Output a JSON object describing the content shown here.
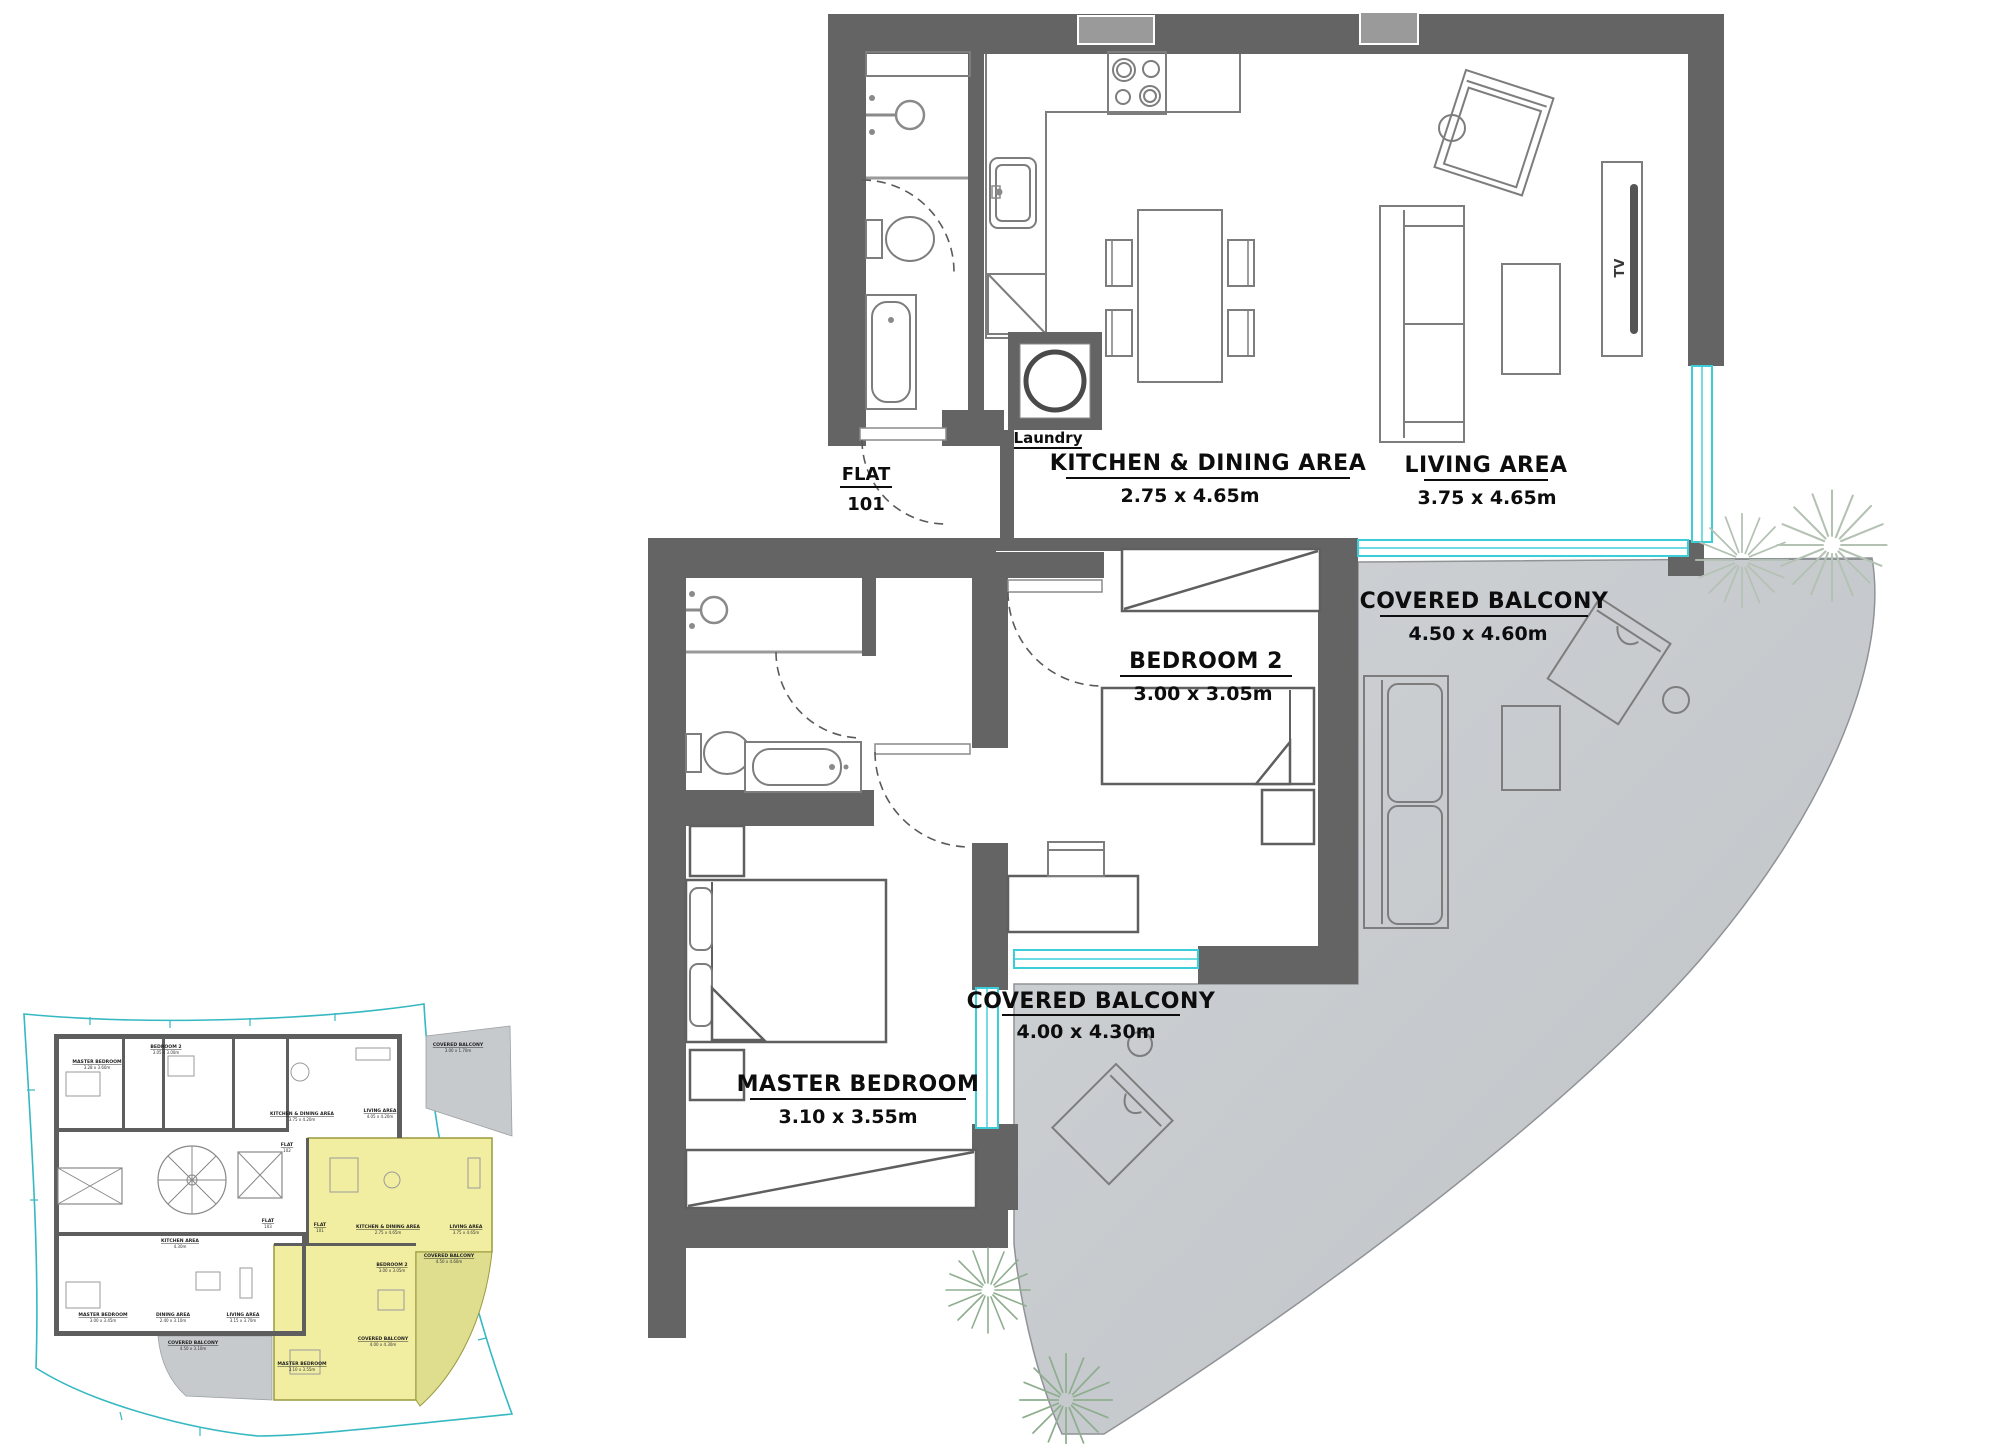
{
  "main_plan": {
    "flat": {
      "label": "FLAT",
      "number": "101"
    },
    "laundry_label": "Laundry",
    "tv_label": "TV",
    "rooms": {
      "kitchen": {
        "name": "KITCHEN & DINING AREA",
        "dims": "2.75 x 4.65m"
      },
      "living": {
        "name": "LIVING AREA",
        "dims": "3.75 x 4.65m"
      },
      "bedroom2": {
        "name": "BEDROOM 2",
        "dims": "3.00 x 3.05m"
      },
      "master": {
        "name": "MASTER BEDROOM",
        "dims": "3.10 x 3.55m"
      },
      "balcony_upper": {
        "name": "COVERED BALCONY",
        "dims": "4.50 x 4.60m"
      },
      "balcony_lower": {
        "name": "COVERED BALCONY",
        "dims": "4.00 x 4.30m"
      }
    }
  },
  "key_plan": {
    "labels": [
      {
        "name": "MASTER BEDROOM",
        "dims": "3.28 x 3.60m"
      },
      {
        "name": "BEDROOM 2",
        "dims": "3.05 x 3.00m"
      },
      {
        "name": "KITCHEN & DINING AREA",
        "dims": "3.75 x 4.20m"
      },
      {
        "name": "LIVING AREA",
        "dims": "4.05 x 4.20m"
      },
      {
        "name": "COVERED BALCONY",
        "dims": "3.00 x 1.70m"
      },
      {
        "name": "FLAT",
        "dims": "102"
      },
      {
        "name": "FLAT",
        "dims": "103"
      },
      {
        "name": "FLAT",
        "dims": "101"
      },
      {
        "name": "KITCHEN AREA",
        "dims": "4.30m"
      },
      {
        "name": "MASTER BEDROOM",
        "dims": "3.00 x 3.45m"
      },
      {
        "name": "DINING AREA",
        "dims": "2.40 x 3.10m"
      },
      {
        "name": "LIVING AREA",
        "dims": "3.15 x 3.70m"
      },
      {
        "name": "COVERED BALCONY",
        "dims": "4.50 x 3.10m"
      },
      {
        "name": "KITCHEN & DINING AREA",
        "dims": "2.75 x 4.65m"
      },
      {
        "name": "LIVING AREA",
        "dims": "3.75 x 4.65m"
      },
      {
        "name": "BEDROOM 2",
        "dims": "3.00 x 3.05m"
      },
      {
        "name": "COVERED BALCONY",
        "dims": "4.50 x 4.60m"
      },
      {
        "name": "MASTER BEDROOM",
        "dims": "3.10 x 3.55m"
      },
      {
        "name": "COVERED BALCONY",
        "dims": "4.00 x 4.30m"
      }
    ]
  },
  "colors": {
    "wall": "#646464",
    "window_cyan": "#3bcdd8",
    "balcony_gray": "#c9cdd1",
    "highlight_yellow": "#f2eea1",
    "boundary_teal": "#35b8c2",
    "plant_green": "#8fae8f"
  }
}
